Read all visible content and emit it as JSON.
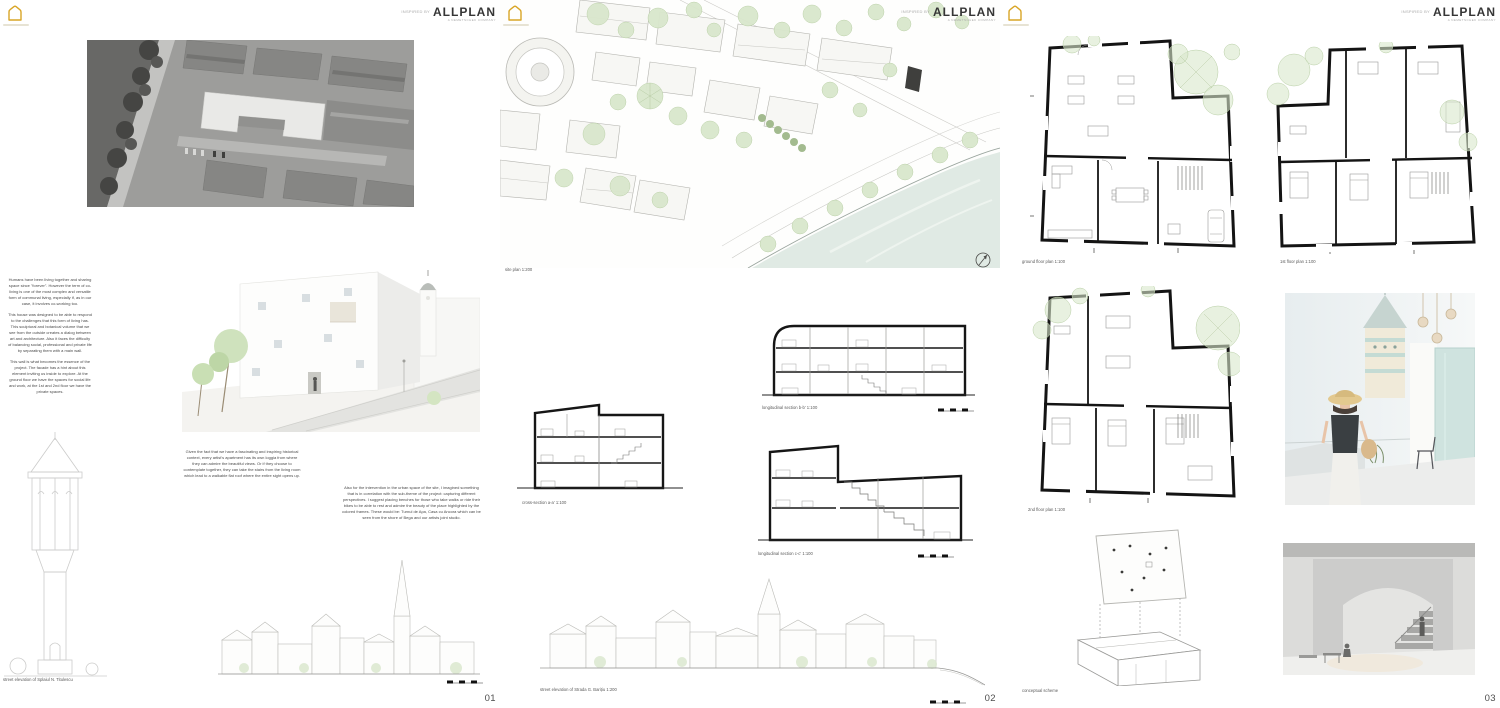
{
  "brand": {
    "prefix": "INSPIRED BY",
    "name": "ALLPLAN",
    "subtitle": "A NEMETSCHEK COMPANY"
  },
  "colors": {
    "accent_yellow": "#D9A627",
    "tree_green": "#d9e7cc",
    "bush_green": "#a3bb8f",
    "water_green": "#e0eae4",
    "wall_ink": "#161616",
    "label_gray": "#5a5a5a",
    "teal_frame": "#cfe3df"
  },
  "panels": [
    {
      "number": "01",
      "texts": {
        "intro": "Humans have been living together and sharing space since \"forever\". However the term of co-living is one of the most complex and versatile form of communal living, especially if, as in our case, it involves co-working too.",
        "design": "This house was designed to be able to respond to the challenges that this form of living has. This sculptural and botanical volume that we see from the outside creates a dialog between art and architecture. Also it faces the difficulty of balancing social, professional and private life by separating them with a main wall.",
        "wall": "This wall is what becomes the essence of the project. The facade has a hint about this element inviting us inside to explore. At the ground floor we have the spaces for social life and work, at the 1st and 2nd floor we have the private spaces.",
        "loggia": "Given the fact that we have a fascinating and inspiring historical context, every artist's apartment has its own loggia from where they can admire the beautiful views. Or if they choose to contemplate together, they can take the stairs from the living room which lead to a walkable flat roof where the entire sight opens up.",
        "urban": "Also for the intervention in the urban space of the site, I imagined something that is in correlation with the sub-theme of the project: capturing different perspectives. I suggest placing benches for those who take walks or ride their bikes to be able to rest and admire the beauty of the place highlighted by the colored frames. These would be: Turnul de Apa, Casa cu Ancora which can be seen from the shore of Bega and our artists joint studio."
      },
      "labels": {
        "street_elevation": "street elevation of Splaiul N. Titulescu"
      }
    },
    {
      "number": "02",
      "labels": {
        "site_plan": "site plan 1:200",
        "cross_section": "cross-section a-a' 1:100",
        "long_section_b": "longitudinal section b-b' 1:100",
        "long_section_c": "longitudinal section c-c' 1:100",
        "street_elevation": "street elevation of Strada G. Barițiu 1:200"
      }
    },
    {
      "number": "03",
      "labels": {
        "ground_floor": "ground floor plan 1:100",
        "first_floor": "1st floor plan 1:100",
        "second_floor": "2nd floor plan 1:100",
        "conceptual": "conceptual scheme"
      }
    }
  ]
}
